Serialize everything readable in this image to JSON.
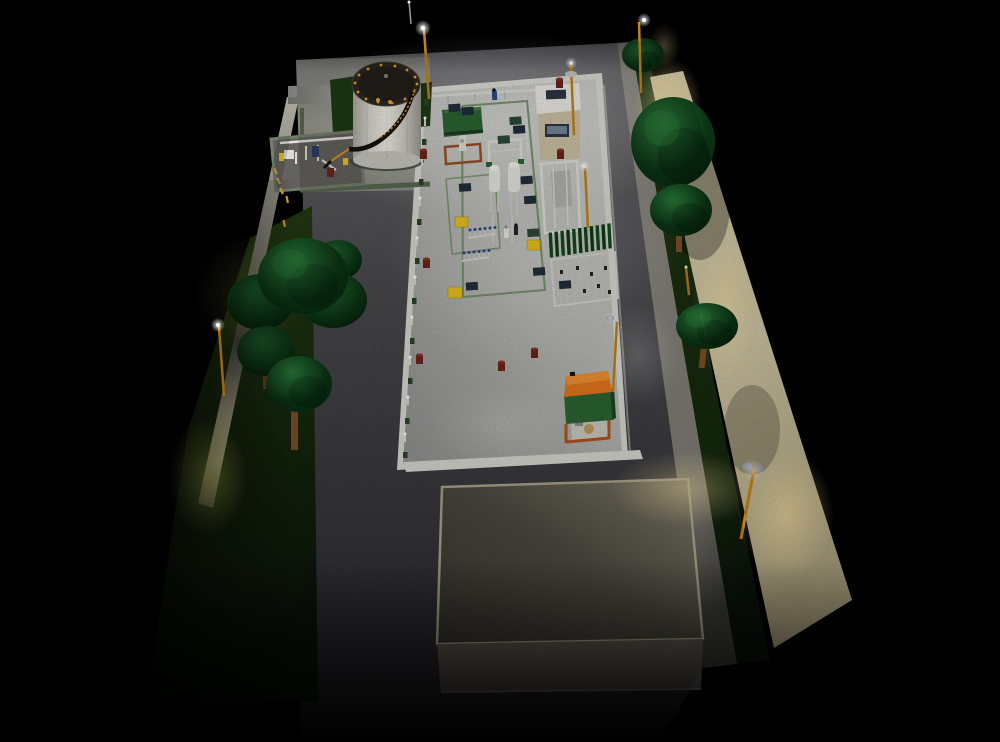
{
  "canvas": {
    "width": 1000,
    "height": 742,
    "time_of_day": "night"
  },
  "palette": {
    "bg": "#000000",
    "asphalt_light": "#6c6c70",
    "asphalt_mid": "#4a4a4e",
    "asphalt_dark": "#1e1e21",
    "concrete": "#b7b7b3",
    "concrete_bright": "#d8d8d1",
    "curb": "#d9d9d2",
    "grass": "#1b300f",
    "grass_lit": "#43581c",
    "grass_glow": "#d8e060",
    "sidewalk": "#8e8c82",
    "road_warm": "#cfc5a2",
    "road_glow": "#f2e7c2",
    "tree": "#1c6330",
    "tree_dark": "#0b3415",
    "trunk": "#7d5124",
    "tank_body": "#e9e7df",
    "tank_top": "#2c2822",
    "steel_white": "#e2e2dc",
    "accent_yellow": "#e9c41e",
    "lamp_orange": "#c28418",
    "safety_orange": "#e4771c",
    "unit_green": "#2d6534",
    "fence_green": "#2a4528",
    "rail_green": "#6f8f63",
    "hedge_green": "#124a1e",
    "navy": "#222f3c",
    "barrel_red": "#6f241a",
    "roof_dark": "#34332c",
    "roof_lit": "#8a8272",
    "trim": "#a9a188",
    "wall_tan": "#cfc3a6",
    "window": "#2a3648",
    "light_white": "#ffffff",
    "light_warm": "#ffe4a0"
  },
  "scene": {
    "objects": [
      "night-sky",
      "asphalt-lot",
      "equipment-yard",
      "perimeter-fence",
      "storage-tank",
      "tank-spiral-stair",
      "pipe-manifold-pad",
      "guard-house",
      "canopy-shed",
      "separator-vessels",
      "pipe-rack-frame",
      "compressor-louvers",
      "valve-manifolds",
      "pumpjack-shelter",
      "warehouse-building",
      "street-road",
      "sidewalk",
      "grass-verge",
      "low-poly-trees",
      "street-lamps",
      "light-mast",
      "workers",
      "barrels",
      "utility-boxes",
      "yellow-crates"
    ]
  }
}
